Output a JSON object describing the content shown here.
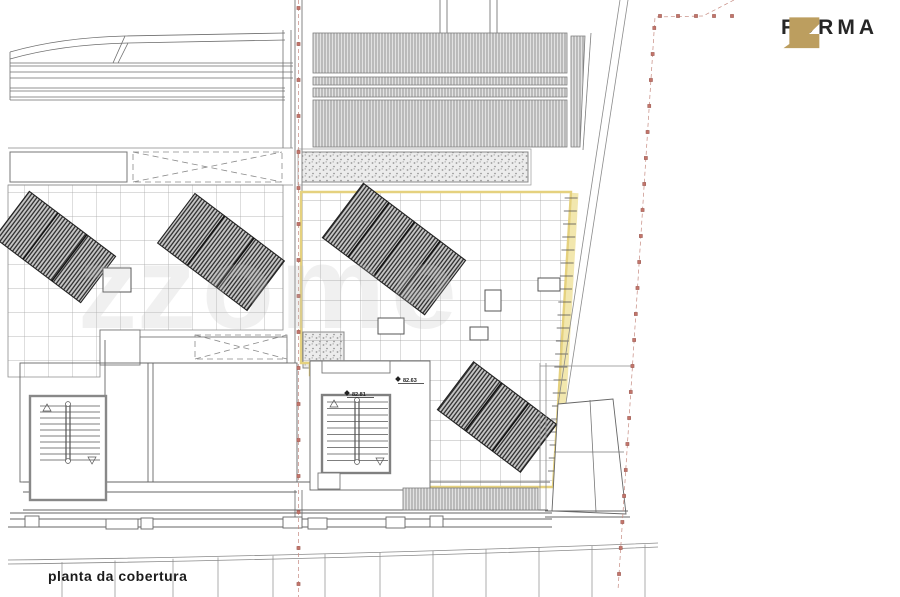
{
  "page": {
    "background": "#ffffff"
  },
  "logo": {
    "brand": "FORMA",
    "icon": "z-monogram-icon",
    "icon_color": "#BC9E5F",
    "text_color": "#262626"
  },
  "caption": {
    "title": "planta da cobertura"
  },
  "watermark": {
    "glyph": "z",
    "text": "zome"
  },
  "levels": [
    {
      "id": "level-1",
      "value": "82.81"
    },
    {
      "id": "level-2",
      "value": "82.63"
    }
  ],
  "plan": {
    "type": "roof-plan",
    "highlight_color": "#E5D17E",
    "highlight_band_color": "#F2E7AE",
    "boundary_marker_color": "#C4756B",
    "line_color": "#6E6E6E",
    "zones": [
      "neighbor-roof-bands-top-left",
      "corrugated-roof-top-center",
      "gravel-strip",
      "tiled-terrace-left",
      "tiled-terrace-central-highlighted",
      "solar-panel-array-1",
      "solar-panel-array-2",
      "solar-panel-array-3",
      "solar-panel-array-4",
      "stairwell-left",
      "stairwell-central",
      "street-edge-bottom",
      "property-boundary-left",
      "property-boundary-right"
    ]
  }
}
